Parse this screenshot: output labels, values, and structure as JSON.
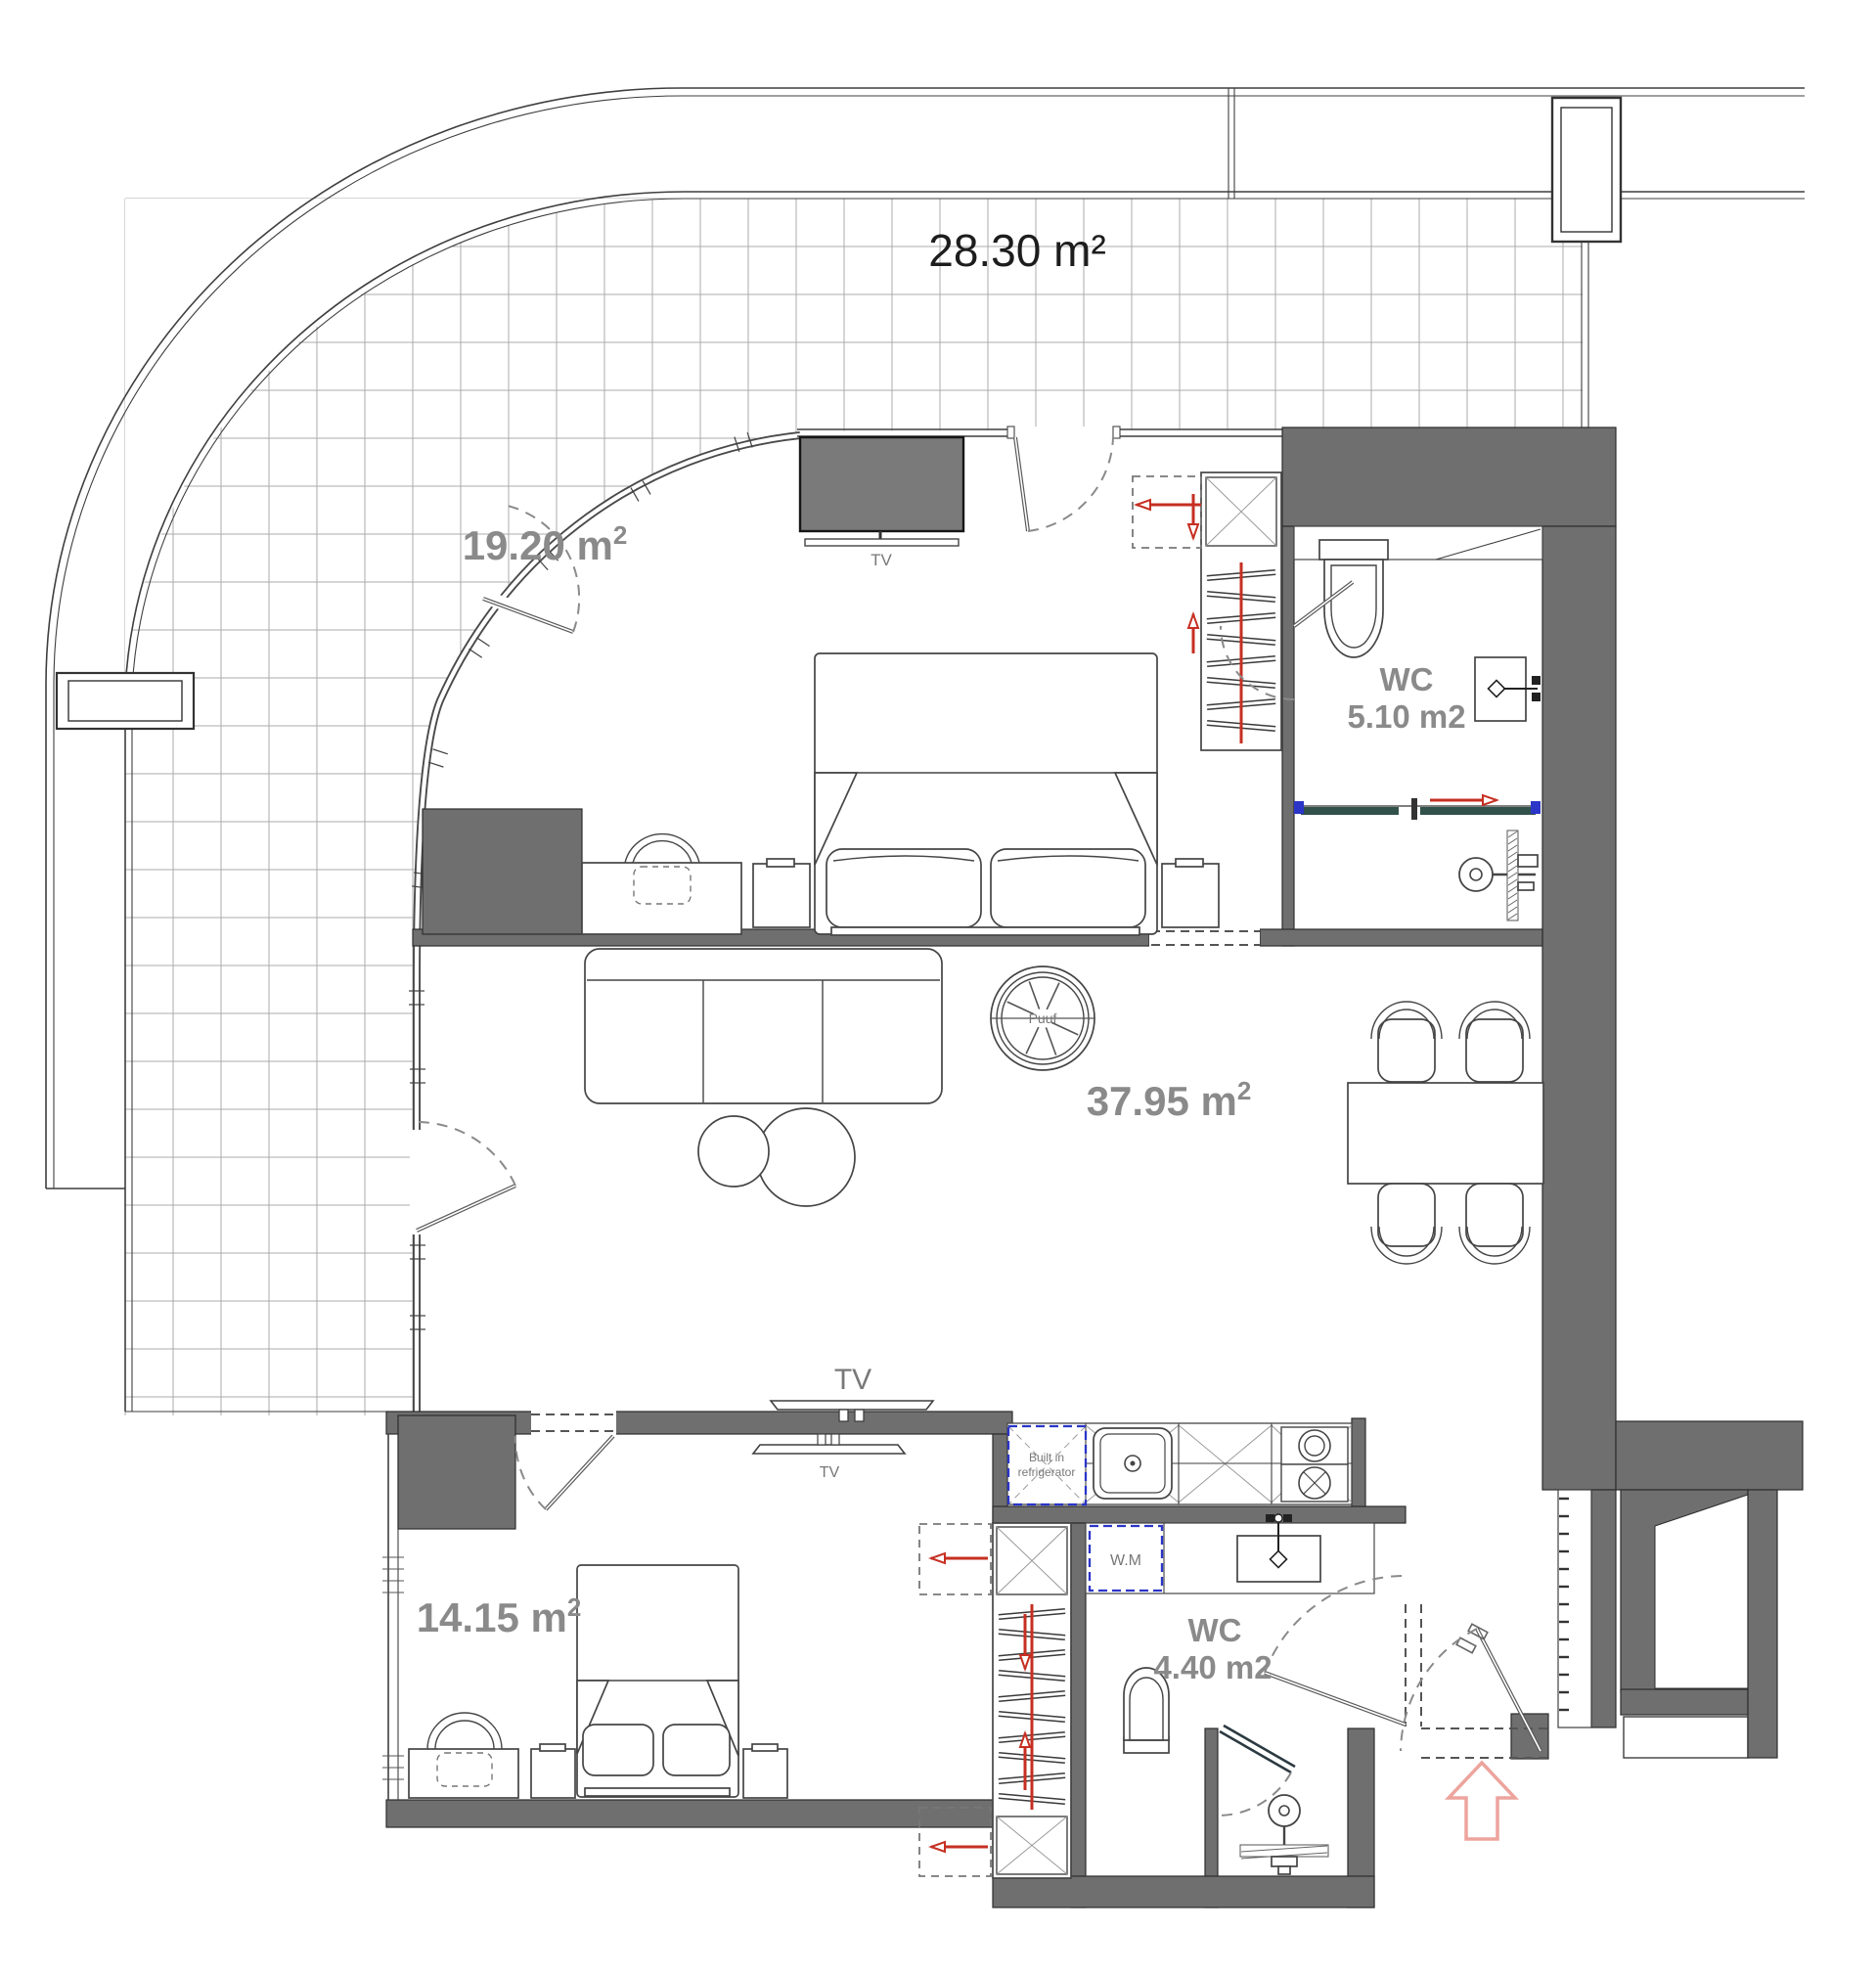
{
  "title": "Apartment floor plan",
  "colors": {
    "wall": "#6f6f6f",
    "label": "#8a8a8a",
    "red": "#c62f22",
    "red_light": "#eda49d",
    "blue": "#2b35c8"
  },
  "rooms": {
    "balcony": {
      "area_label": "28.30 m²"
    },
    "bedroom_1": {
      "area_value": "19.20 m",
      "area_sup": "2"
    },
    "living": {
      "area_value": "37.95 m",
      "area_sup": "2"
    },
    "bedroom_2": {
      "area_value": "14.15 m",
      "area_sup": "2"
    },
    "wc_1": {
      "name": "WC",
      "area_label": "5.10 m2"
    },
    "wc_2": {
      "name": "WC",
      "area_label": "4.40 m2"
    }
  },
  "furniture": {
    "tv_bedroom_1": "TV",
    "tv_living": "TV",
    "tv_bedroom_2": "TV",
    "pouf": "Puuf",
    "refrigerator_line1": "Built in",
    "refrigerator_line2": "refrigerator",
    "washing_machine": "W.M"
  }
}
